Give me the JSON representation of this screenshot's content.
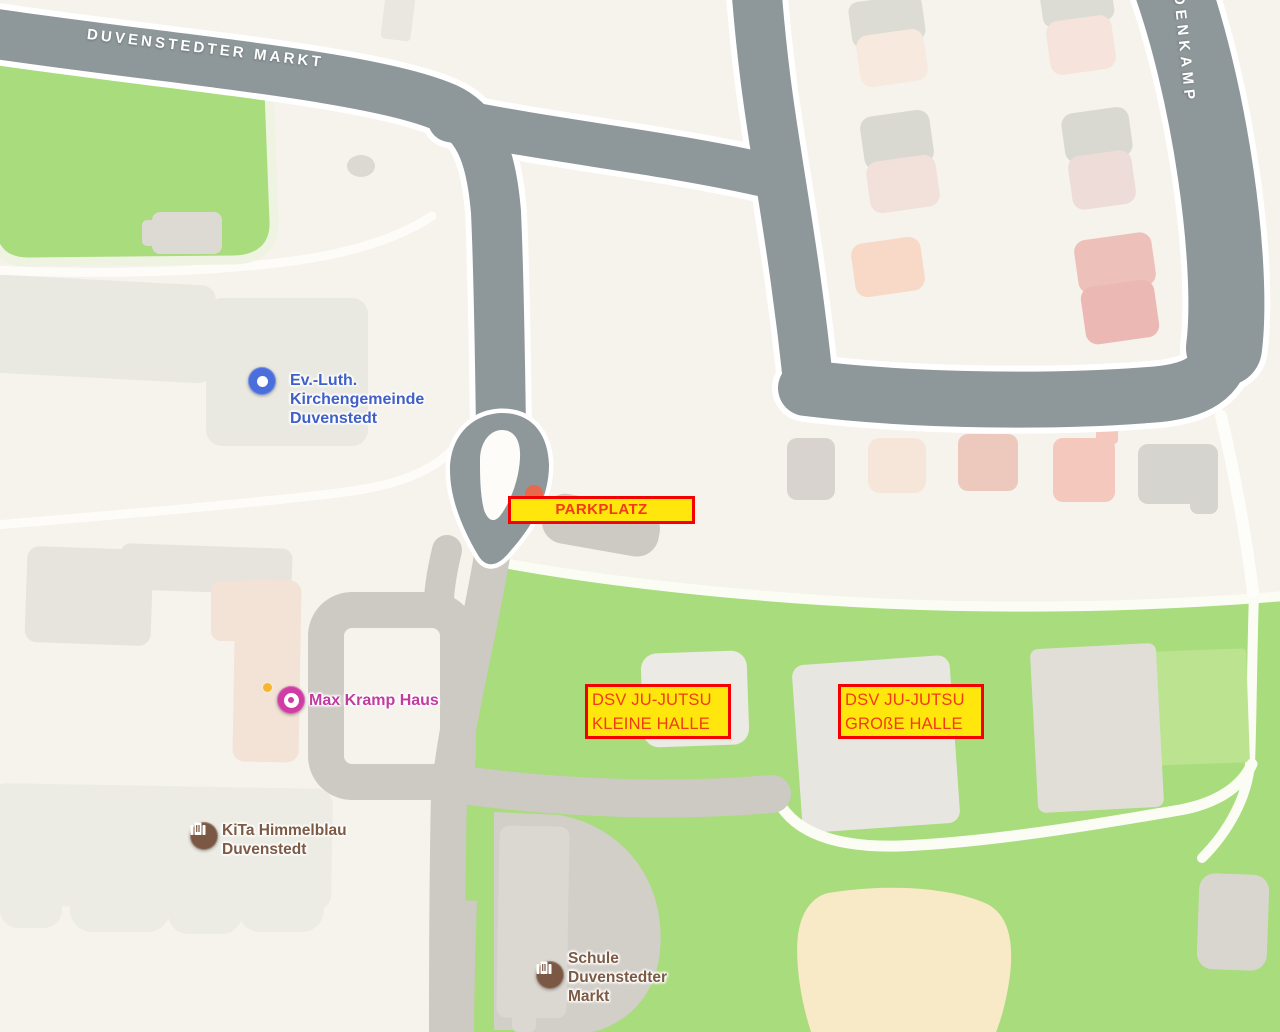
{
  "streets": {
    "street1": "DUVENSTEDTER MARKT",
    "street2": "IDENKAMP"
  },
  "pois": {
    "church": {
      "lines": [
        "Ev.-Luth.",
        "Kirchengemeinde",
        "Duvenstedt"
      ],
      "color": "#4060c8",
      "icon": "circle-dot"
    },
    "max_kramp": {
      "lines": [
        "Max Kramp Haus"
      ],
      "color": "#c23c9e",
      "icon": "circle-ring"
    },
    "kita": {
      "lines": [
        "KiTa Himmelblau",
        "Duvenstedt"
      ],
      "color": "#7d5a43",
      "icon": "building"
    },
    "schule": {
      "lines": [
        "Schule",
        "Duvenstedter",
        "Markt"
      ],
      "color": "#7d5a43",
      "icon": "building"
    }
  },
  "annotations": {
    "parkplatz": {
      "lines": [
        "PARKPLATZ"
      ]
    },
    "kleine_halle": {
      "lines": [
        "DSV JU-JUTSU",
        "KLEINE HALLE"
      ]
    },
    "grosse_halle": {
      "lines": [
        "DSV JU-JUTSU",
        "GROßE HALLE"
      ]
    },
    "style": {
      "background": "#ffe70d",
      "border": "#f50000",
      "text": "#f23a16"
    }
  },
  "map_colors": {
    "background": "#f6f2ec",
    "road_major": "#8e979a",
    "road_minor": "#cdc9c3",
    "road_casing": "#ffffff",
    "grass": "#a8dc7d",
    "grass_light": "#bbe390",
    "sand": "#f8e9c7",
    "building_gray": "#dcdcd5",
    "building_pink": "#eec0ba"
  }
}
